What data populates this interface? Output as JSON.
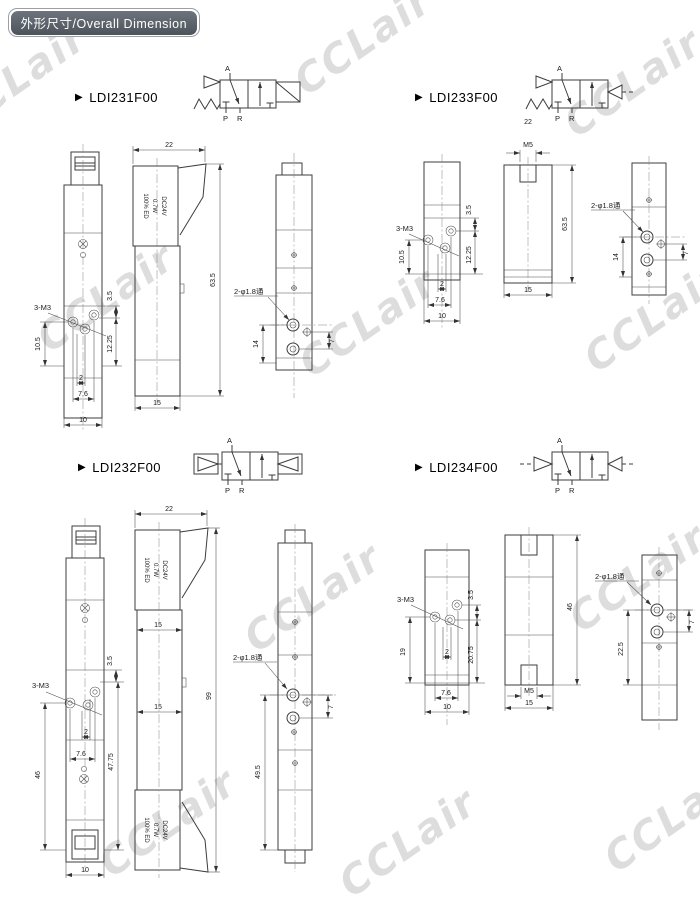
{
  "header": {
    "badge_label": "外形尺寸/Overall Dimension"
  },
  "watermark_text": "CCLair",
  "sections": [
    {
      "model": "LDI231F00",
      "ports": {
        "a": "A",
        "p": "P",
        "r": "R"
      },
      "coil_label": {
        "line1": "DC24V",
        "line2": "0.7W",
        "line3": "100% ED"
      },
      "dims": {
        "width_top": "22",
        "height_total": "63.5",
        "depth": "15",
        "mount_thread": "3-M3",
        "hole_offset": "3.5",
        "mount_left": "10.5",
        "mount_right": "12.25",
        "hole_gap": "2",
        "hole_span": "7.6",
        "width_front": "10",
        "port_note": "2-φ1.8通",
        "port_span": "14",
        "port_gap": "7"
      }
    },
    {
      "model": "LDI233F00",
      "ports": {
        "a": "A",
        "p": "P",
        "r": "R"
      },
      "dims": {
        "width_top": "22",
        "pilot_thread": "M5",
        "height_total": "63.5",
        "depth": "15",
        "mount_thread": "3-M3",
        "hole_offset": "3.5",
        "mount_left": "10.5",
        "mount_right": "12.25",
        "hole_gap": "2",
        "hole_span": "7.6",
        "width_front": "10",
        "port_note": "2-φ1.8通",
        "port_span": "14",
        "port_gap": "7"
      }
    },
    {
      "model": "LDI232F00",
      "ports": {
        "a": "A",
        "p": "P",
        "r": "R"
      },
      "coil_label": {
        "line1": "DC24V",
        "line2": "0.7W",
        "line3": "100% ED"
      },
      "dims": {
        "width_top": "22",
        "depth_upper": "15",
        "depth_lower": "15",
        "height_total": "99",
        "mount_thread": "3-M3",
        "hole_offset": "3.5",
        "hole_gap": "2",
        "hole_span": "7.6",
        "mount_left": "46",
        "mount_right": "47.75",
        "width_front": "10",
        "port_note": "2-φ1.8通",
        "port_gap": "7",
        "port_span": "49.5"
      }
    },
    {
      "model": "LDI234F00",
      "ports": {
        "a": "A",
        "p": "P",
        "r": "R"
      },
      "dims": {
        "mount_thread": "3-M3",
        "hole_offset": "3.5",
        "mount_left": "19",
        "mount_right": "20.75",
        "hole_gap": "2",
        "hole_span": "7.6",
        "width_front": "10",
        "pilot_thread": "M5",
        "depth": "15",
        "height_total": "46",
        "port_note": "2-φ1.8通",
        "port_gap": "7",
        "port_span": "22.5"
      }
    }
  ]
}
